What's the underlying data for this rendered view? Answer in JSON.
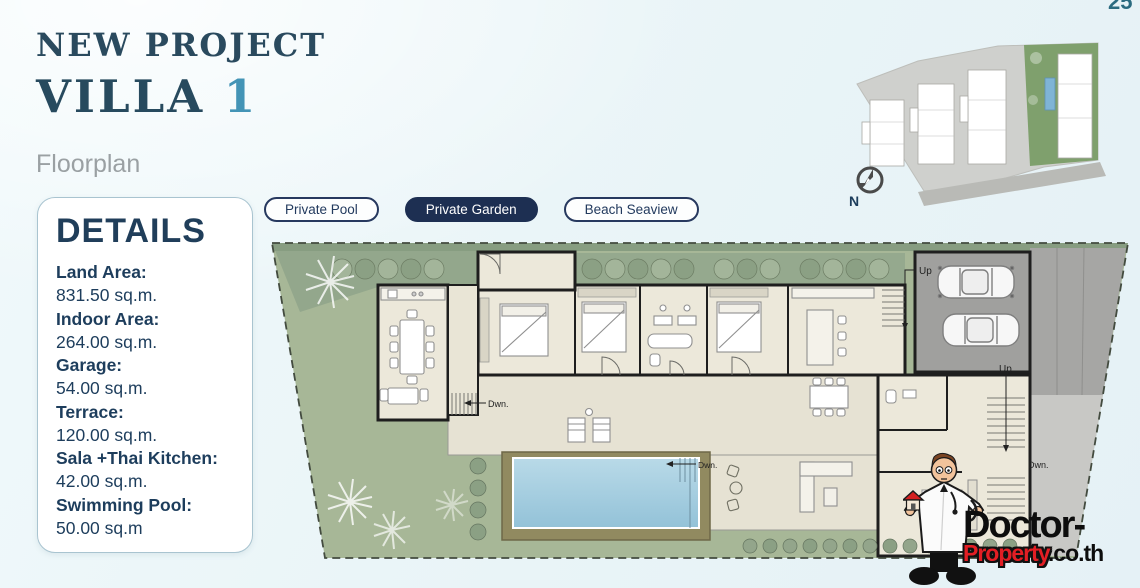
{
  "page_number": "25",
  "header": {
    "eyebrow": "NEW PROJECT",
    "title": "VILLA",
    "title_accent": "1",
    "section": "Floorplan"
  },
  "details": {
    "title": "DETAILS",
    "items": [
      {
        "label": "Land Area:",
        "value": "831.50 sq.m."
      },
      {
        "label": "Indoor Area:",
        "value": "264.00 sq.m."
      },
      {
        "label": "Garage:",
        "value": "54.00 sq.m."
      },
      {
        "label": "Terrace:",
        "value": "120.00 sq.m."
      },
      {
        "label": "Sala +Thai Kitchen:",
        "value": "42.00 sq.m."
      },
      {
        "label": "Swimming Pool:",
        "value": "50.00 sq.m"
      }
    ]
  },
  "tags": [
    {
      "label": "Private Pool",
      "active": false
    },
    {
      "label": "Private Garden",
      "active": true
    },
    {
      "label": "Beach Seaview",
      "active": false
    }
  ],
  "sitemap": {
    "compass_label": "N"
  },
  "floorplan": {
    "labels": {
      "up_garage": "Up",
      "up_right": "Up",
      "dwn_hall": "Dwn.",
      "dwn_pool": "Dwn.",
      "dwn_right": "Dwn."
    }
  },
  "logo": {
    "part1": "Doctor-",
    "part2": "Property",
    "part3": ".co.th"
  },
  "colors": {
    "accent_teal": "#4394b6",
    "navy": "#274a5e",
    "tag_active_bg": "#1d2f52",
    "lawn_green": "#a7b797",
    "pool_blue": "#a9cfe2",
    "logo_red": "#e31e24"
  }
}
